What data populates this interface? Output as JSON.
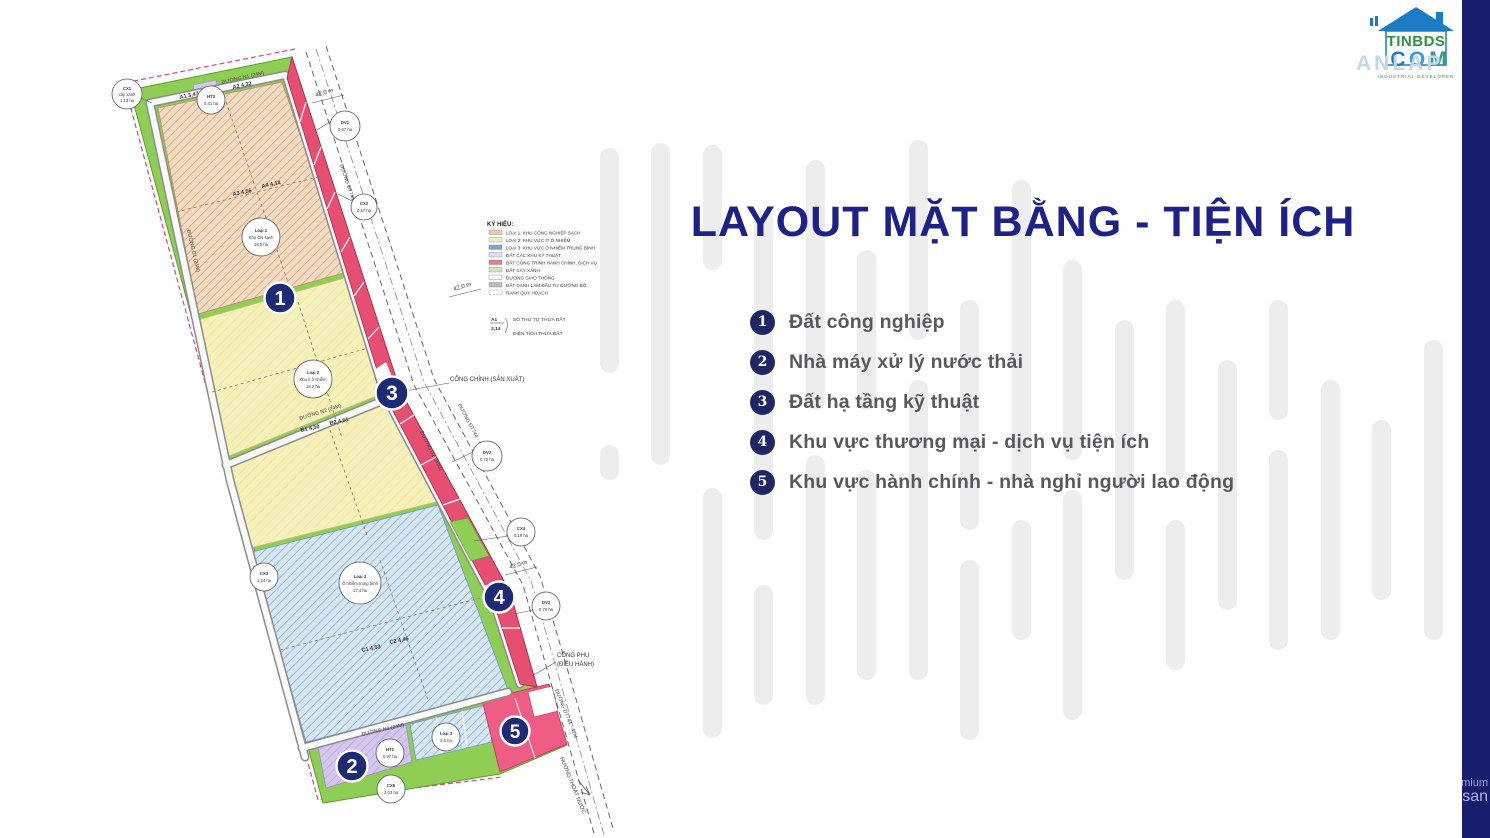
{
  "slide": {
    "title": "LAYOUT MẶT BẰNG - TIỆN ÍCH",
    "items": [
      {
        "num": "1",
        "label": "Đất công nghiệp"
      },
      {
        "num": "2",
        "label": "Nhà máy xử lý nước thải"
      },
      {
        "num": "3",
        "label": "Đất hạ tầng kỹ thuật"
      },
      {
        "num": "4",
        "label": "Khu vực thương mại - dịch vụ tiện ích"
      },
      {
        "num": "5",
        "label": "Khu vực hành chính - nhà nghỉ người lao động"
      }
    ]
  },
  "logo": {
    "brand_line1": "TINBDS",
    "com_letters": [
      "C",
      "O",
      "M"
    ],
    "watermark": "ANLAP",
    "tagline": "INDUSTRIAL DEVELOPER"
  },
  "side_watermark": {
    "line1": "mium",
    "line2": "san"
  },
  "map": {
    "legend": {
      "title": "KÝ HIỆU:",
      "entries": [
        {
          "color": "#eec9a6",
          "label": "LOẠI 1: KHU CÔNG NGHIỆP SẠCH"
        },
        {
          "color": "#f5efad",
          "label": "LOẠI 2: KHU VỰC ÍT Ô NHIỄM"
        },
        {
          "color": "#7fa8d0",
          "label": "LOẠI 3: KHU VỰC Ô NHIỄM TRUNG BÌNH"
        },
        {
          "color": "#e4daf0",
          "label": "ĐẤT CÁC KHU KỸ THUẬT"
        },
        {
          "color": "#e77d8d",
          "label": "ĐẤT CÔNG TRÌNH HÀNH CHÍNH, DỊCH VỤ"
        },
        {
          "color": "#cdeab0",
          "label": "ĐẤT CÂY XANH"
        },
        {
          "color": "#f5f5f5",
          "label": "ĐƯỜNG GIAO THÔNG"
        },
        {
          "color": "#bdbdbd",
          "label": "ĐẤT DÀNH LÀM ĐẦU TƯ ĐƯỜNG BỘ"
        },
        {
          "color": "#ffffff",
          "label": "RANH QUY HOẠCH"
        }
      ],
      "note_code": "A1",
      "note_area": "3,14",
      "note_code_label": "SỐ THỨ TỰ THỬA ĐẤT",
      "note_area_label": "DIỆN TÍCH THỬA ĐẤT"
    },
    "markers": [
      {
        "num": "1"
      },
      {
        "num": "2"
      },
      {
        "num": "3"
      },
      {
        "num": "4"
      },
      {
        "num": "5"
      }
    ],
    "roads": {
      "n1": "ĐƯỜNG N1 (24M)",
      "n2": "ĐƯỜNG N2 (24M)",
      "n3": "ĐƯỜNG N3 (24M)",
      "d1": "ĐƯỜNG D1 (24M)",
      "d2": "ĐƯỜNG D2 (24M)",
      "dt744": "ĐƯỜNG ĐT744 - 42M"
    },
    "gates": {
      "main": "CỔNG CHÍNH (SẢN XUẤT)",
      "sub1": "CỔNG PHỤ",
      "sub2": "(ĐIỀU HÀNH)"
    },
    "drain": "HƯỚNG THOÁT NƯỚC",
    "dim": "42,0 m",
    "lots": {
      "a1": "A1  3,47",
      "a2": "A2  4,32",
      "a3": "A3  4,56",
      "a4": "A4  4,14",
      "b1": "B1  4,50",
      "b2": "B2  4,51",
      "c1": "C1  4,53",
      "c2": "C2  4,46"
    },
    "zone_circles": [
      {
        "l1": "Loại 1",
        "l2": "Khu CN sạch",
        "l3": "18,5 ha"
      },
      {
        "l1": "Loại 2",
        "l2": "Khu ít ô nhiễm",
        "l3": "18,2 ha"
      },
      {
        "l1": "Loại 3",
        "l2": "Ô nhiễm trung bình",
        "l3": "17,4 ha"
      }
    ],
    "callouts": [
      {
        "l1": "CX1",
        "l2": "cây xanh",
        "l3": "1,13 ha"
      },
      {
        "l1": "HT3",
        "l2": "0,41 ha",
        "l3": ""
      },
      {
        "l1": "DV1",
        "l2": "0,67 ha",
        "l3": ""
      },
      {
        "l1": "CX2",
        "l2": "0,57 ha",
        "l3": ""
      },
      {
        "l1": "DV2",
        "l2": "0,72 ha",
        "l3": ""
      },
      {
        "l1": "CX3",
        "l2": "1,24 ha",
        "l3": ""
      },
      {
        "l1": "CX4",
        "l2": "0,19 ha",
        "l3": ""
      },
      {
        "l1": "DV3",
        "l2": "0,70 ha",
        "l3": ""
      },
      {
        "l1": "Loại 3",
        "l2": "2,5 ha",
        "l3": ""
      },
      {
        "l1": "HT1",
        "l2": "0,97 ha",
        "l3": ""
      },
      {
        "l1": "CX5",
        "l2": "2,03 ha",
        "l3": ""
      }
    ]
  },
  "colors": {
    "title_navy": "#1c2288",
    "bullet_navy": "#1d2766",
    "sidebar_navy": "#191d6e",
    "green_band": "#8fce55",
    "strip_pink": "#e64e72",
    "zone5_pink": "#ef5d85"
  }
}
